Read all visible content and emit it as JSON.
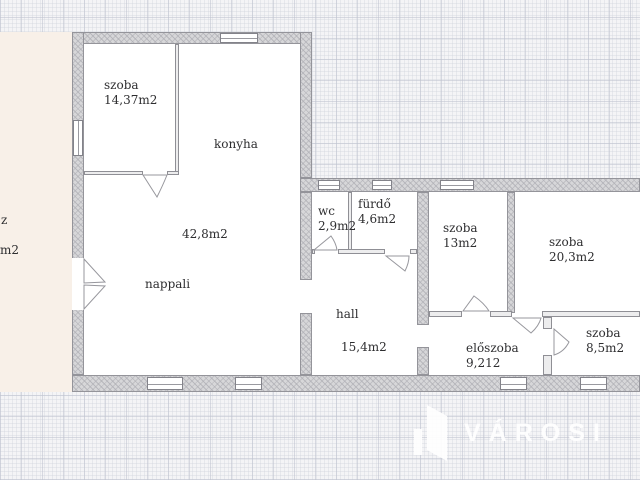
{
  "plan": {
    "rooms": {
      "szoba1": {
        "name": "szoba",
        "area": "14,37m2"
      },
      "konyha": {
        "name": "konyha"
      },
      "nappali": {
        "name": "nappali",
        "area": "42,8m2"
      },
      "wc": {
        "name": "wc",
        "area": "2,9m2"
      },
      "furdo": {
        "name": "fürdő",
        "area": "4,6m2"
      },
      "szoba2": {
        "name": "szoba",
        "area": "13m2"
      },
      "szoba3": {
        "name": "szoba",
        "area": "20,3m2"
      },
      "hall": {
        "name": "hall",
        "area": "15,4m2"
      },
      "eloszoba": {
        "name": "előszoba",
        "area": "9,212"
      },
      "szoba4": {
        "name": "szoba",
        "area": "8,5m2"
      }
    },
    "terrace_fragment": {
      "line1": "z",
      "line2": "m2"
    }
  },
  "watermark": {
    "brand": "VÁROSI"
  },
  "colors": {
    "background": "#f4f4f6",
    "wall": "#d7d7d9",
    "terrace": "#f8f0e8",
    "watermark": "#ffffff",
    "text": "#2e2e30"
  }
}
